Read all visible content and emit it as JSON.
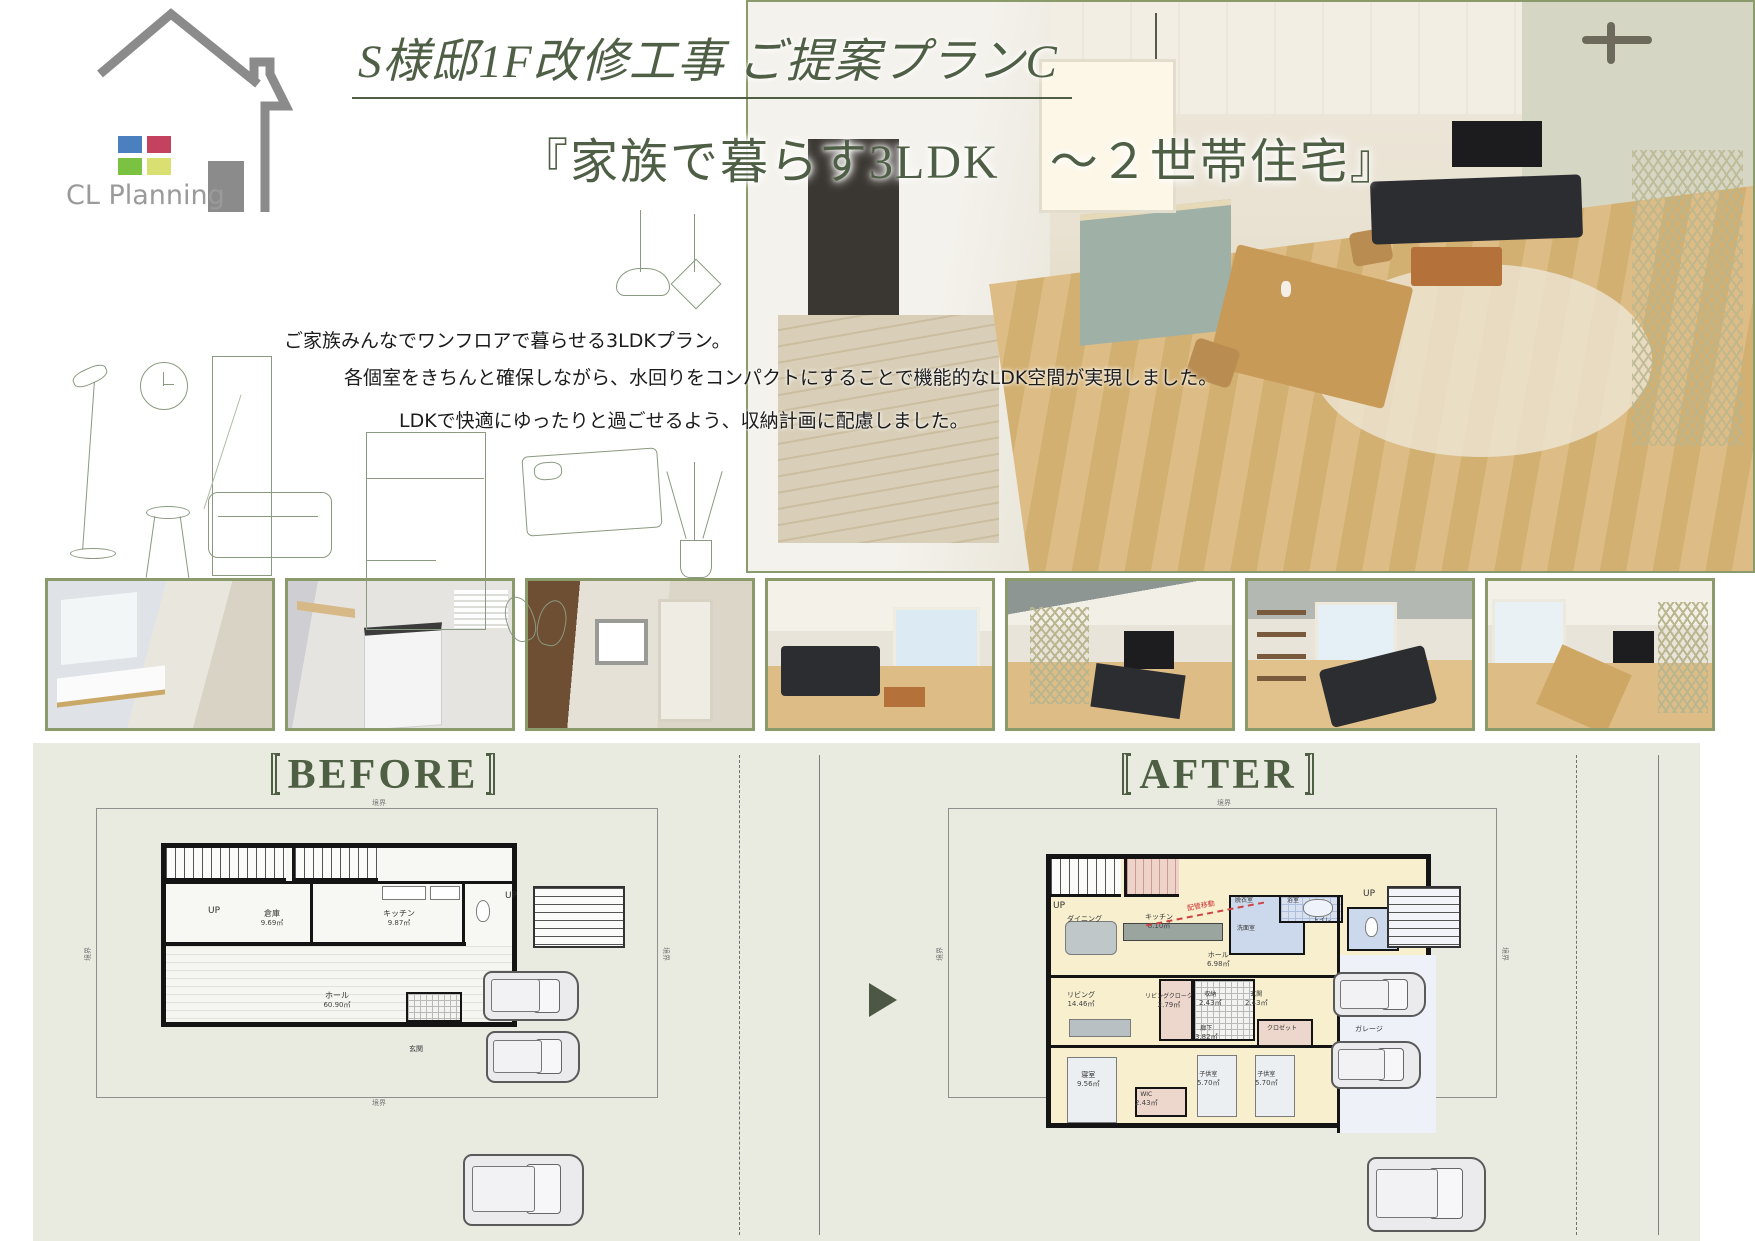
{
  "accent": {
    "green_dark": "#4e5f43",
    "sage_border": "#8a9a6b",
    "section_bg": "#e9ebe1"
  },
  "logo": {
    "company": "CL Planning",
    "colors": {
      "house_gray": "#8b8b8b",
      "sq_blue": "#4a7fc0",
      "sq_red": "#c4415f",
      "sq_green": "#7cc242",
      "sq_yellow": "#d9df70"
    }
  },
  "header": {
    "title": "S様邸1F改修工事 ご提案プランC",
    "subtitle": "『家族で暮らす3LDK　～２世帯住宅』"
  },
  "description": {
    "line1": "ご家族みんなでワンフロアで暮らせる3LDKプラン。",
    "line2": "各個室をきちんと確保しながら、水回りをコンパクトにすることで機能的なLDK空間が実現しました。",
    "line3": "LDKで快適にゆったりと過ごせるよう、収納計画に配慮しました。"
  },
  "gallery": {
    "items": [
      {
        "name": "powder-room-render"
      },
      {
        "name": "laundry-room-render"
      },
      {
        "name": "hallway-render"
      },
      {
        "name": "living-room-render"
      },
      {
        "name": "living-hammock-render"
      },
      {
        "name": "dining-living-render"
      },
      {
        "name": "kitchen-dining-render"
      }
    ]
  },
  "comparison": {
    "before": {
      "label": "BEFORE",
      "boundary_label": "境界",
      "rooms": {
        "up_inner": "UP",
        "up_outer": "UP",
        "storage": "倉庫",
        "storage_area": "9.69㎡",
        "kitchen": "キッチン",
        "kitchen_area": "9.87㎡",
        "hall": "ホール",
        "hall_area": "60.90㎡",
        "entrance": "玄関"
      }
    },
    "after": {
      "label": "AFTER",
      "boundary_label": "境界",
      "annotation": "配管移動",
      "rooms": {
        "up_inner": "UP",
        "up_outer": "UP",
        "dining": "ダイニング",
        "kitchen": "キッチン",
        "kitchen_area": "8.10㎡",
        "datsui": "脱衣室",
        "bath": "浴室",
        "senmen": "洗面室",
        "toilet": "トイレ",
        "hall": "ホール",
        "hall_area": "6.98㎡",
        "living": "リビング",
        "living_area": "14.46㎡",
        "living_cloak": "リビングクローク",
        "living_cloak_area": "2.79㎡",
        "storage": "収納",
        "storage_area": "2.43㎡",
        "entrance": "玄関",
        "entrance_area": "2.43㎡",
        "hallway": "廊下",
        "hallway_area": "3.82㎡",
        "closet": "クロゼット",
        "bedroom": "寝室",
        "bedroom_area": "9.56㎡",
        "wic": "WIC",
        "wic_area": "2.43㎡",
        "kids1": "子供室",
        "kids1_area": "5.70㎡",
        "kids2": "子供室",
        "kids2_area": "5.70㎡",
        "garage": "ガレージ"
      }
    }
  }
}
